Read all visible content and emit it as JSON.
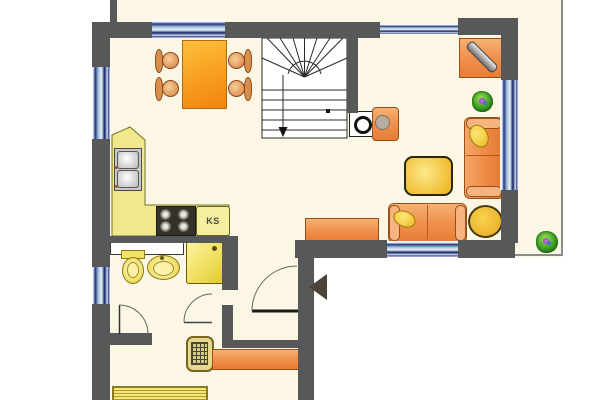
{
  "page": {
    "type": "residential-floor-plan",
    "visible_text": [
      "KS"
    ]
  },
  "labels": {
    "fridge": "KS"
  },
  "colors": {
    "wall": "#57585a",
    "floor": "#fbf7e4",
    "outside": "#ffffff",
    "window_dark_blue": "#1b2a6b",
    "window_light_blue": "#cfe0ee",
    "furniture_orange": "#ee8a44",
    "kitchen_counter_yellow": "#f1e78d",
    "fixture_yellow": "#f0dc52",
    "table_yellow": "#f2c23e",
    "plant_green": "#2e8f1f",
    "stair_line": "#2a2a2a"
  },
  "rooms": [
    {
      "name": "dining-area"
    },
    {
      "name": "living-area"
    },
    {
      "name": "kitchen"
    },
    {
      "name": "bathroom"
    },
    {
      "name": "hallway-entry"
    },
    {
      "name": "stairwell"
    },
    {
      "name": "terrace"
    }
  ],
  "furniture": [
    {
      "name": "dining-table",
      "room": "dining-area"
    },
    {
      "name": "dining-chair",
      "room": "dining-area",
      "count": 4
    },
    {
      "name": "winder-staircase-with-down-arrow",
      "room": "stairwell"
    },
    {
      "name": "wood-stove",
      "room": "living-area"
    },
    {
      "name": "armchair",
      "room": "living-area"
    },
    {
      "name": "tv-sideboard",
      "room": "living-area"
    },
    {
      "name": "sofa-right",
      "room": "living-area"
    },
    {
      "name": "sofa-bottom",
      "room": "living-area"
    },
    {
      "name": "coffee-table",
      "room": "living-area"
    },
    {
      "name": "round-side-table",
      "room": "living-area"
    },
    {
      "name": "sideboard",
      "room": "living-area"
    },
    {
      "name": "kitchen-counter-L",
      "room": "kitchen"
    },
    {
      "name": "double-sink",
      "room": "kitchen"
    },
    {
      "name": "cooktop-4-burners",
      "room": "kitchen"
    },
    {
      "name": "refrigerator",
      "room": "kitchen",
      "label": "KS"
    },
    {
      "name": "wall-cabinet",
      "room": "bathroom"
    },
    {
      "name": "toilet",
      "room": "bathroom"
    },
    {
      "name": "washbasin",
      "room": "bathroom"
    },
    {
      "name": "shower",
      "room": "bathroom"
    },
    {
      "name": "doormat-grate",
      "room": "hallway-entry"
    },
    {
      "name": "sideboard",
      "room": "hallway-entry"
    },
    {
      "name": "radiator",
      "room": "hallway-entry"
    },
    {
      "name": "potted-plant",
      "room": "living-area"
    },
    {
      "name": "potted-plant",
      "room": "terrace"
    },
    {
      "name": "entrance-direction-arrow",
      "room": "hallway-entry"
    }
  ],
  "openings": {
    "windows": 6,
    "doors_with_swing_arcs": 3
  }
}
